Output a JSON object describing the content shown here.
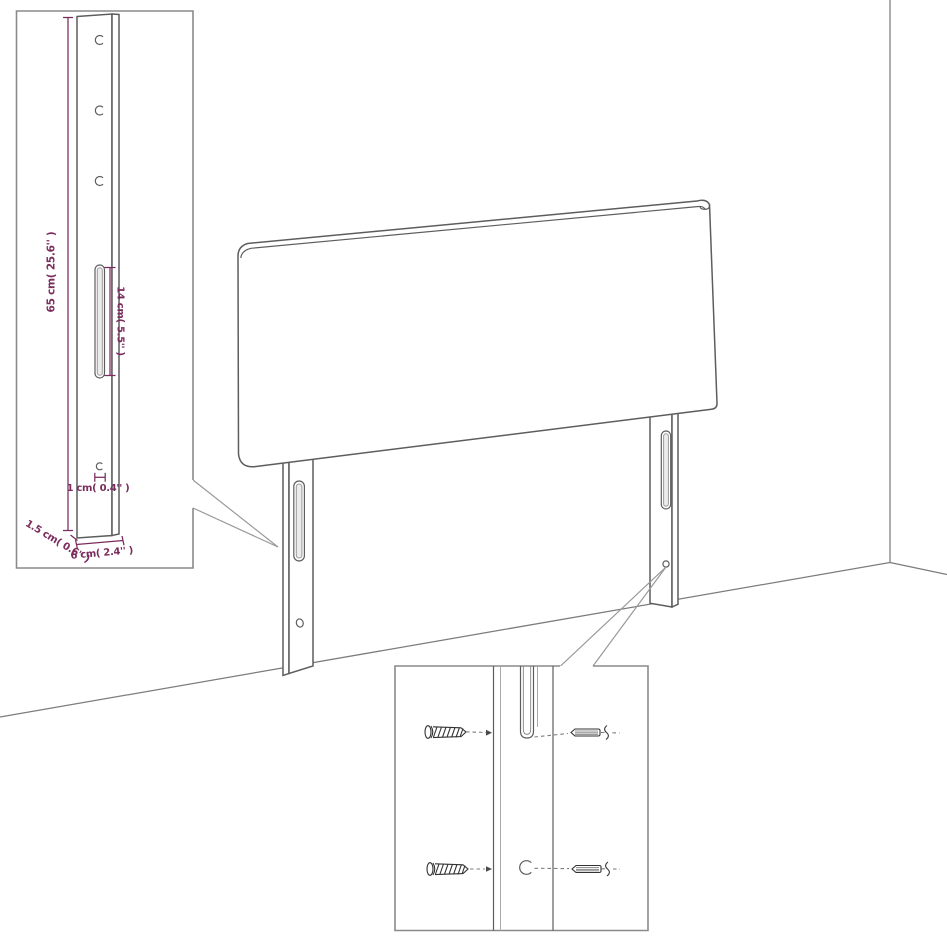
{
  "page": {
    "title": "headboard-assembly-diagram",
    "background": "#ffffff"
  },
  "colors": {
    "accent": "#7a2c5d",
    "outline": "#5d5d5d",
    "inset_border": "#8a8a8a",
    "leader": "#9a9a9a",
    "hardware": "#333333"
  },
  "inset_bracket": {
    "labels": {
      "height": "65 cm( 25.6'' )",
      "slot_length": "14 cm( 5.5'' )",
      "hole_diameter": "1 cm( 0.4'' )",
      "side_thickness": "1.5 cm( 0.6'' )",
      "width": "6 cm( 2.4'' )"
    }
  },
  "icons": {
    "screw": "screw-icon",
    "wall_plug": "wall-plug-icon",
    "mounting_slot": "slot-icon",
    "mounting_hole": "hole-icon"
  }
}
